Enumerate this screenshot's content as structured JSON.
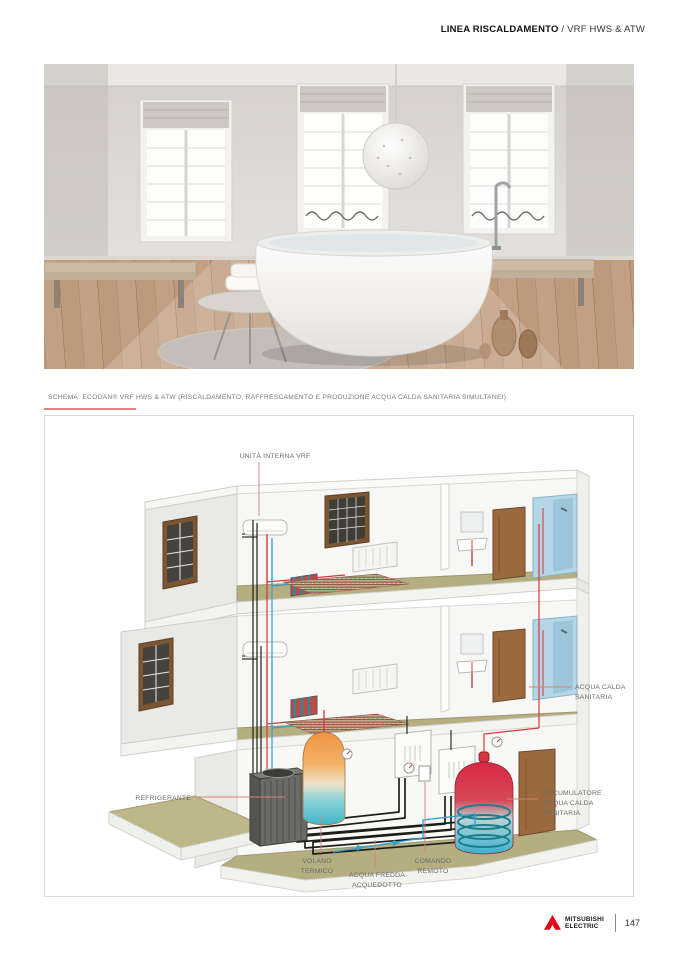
{
  "header": {
    "category": "LINEA RISCALDAMENTO",
    "rest": " / VRF HWS & ATW"
  },
  "schema": {
    "title": "SCHEMA: ECODAN® VRF HWS & ATW (RISCALDAMENTO, RAFFRESCAMENTO E PRODUZIONE ACQUA CALDA SANITARIA SIMULTANEI)"
  },
  "diagram": {
    "labels": {
      "unita_interna_vrf": "UNITÀ INTERNA VRF",
      "acqua_calda_sanitaria": [
        "ACQUA CALDA",
        "SANITARIA"
      ],
      "accumulatore": [
        "ACCUMULATORE",
        "ACQUA CALDA",
        "SANITARIA"
      ],
      "refrigerante": "REFRIGERANTE",
      "volano_termico": [
        "VOLANO",
        "TERMICO"
      ],
      "acqua_fredda": [
        "ACQUA FREDDA",
        "ACQUEDOTTO"
      ],
      "comando_remoto": [
        "COMANDO",
        "REMOTO"
      ]
    }
  },
  "footer": {
    "brand_line1": "MITSUBISHI",
    "brand_line2": "ELECTRIC",
    "page_number": "147"
  },
  "colors": {
    "mitsubishi_red": "#e60012",
    "leader_red": "#d4827b",
    "label_grey": "#6b6b6b",
    "pipe_red": "#d6363a",
    "pipe_blue": "#2e9fd0",
    "pipe_black": "#1d1d1a",
    "floor_khaki": "#b4ae80",
    "shower_blue": "#b5d6e6",
    "door_brown": "#9a6a3e"
  }
}
